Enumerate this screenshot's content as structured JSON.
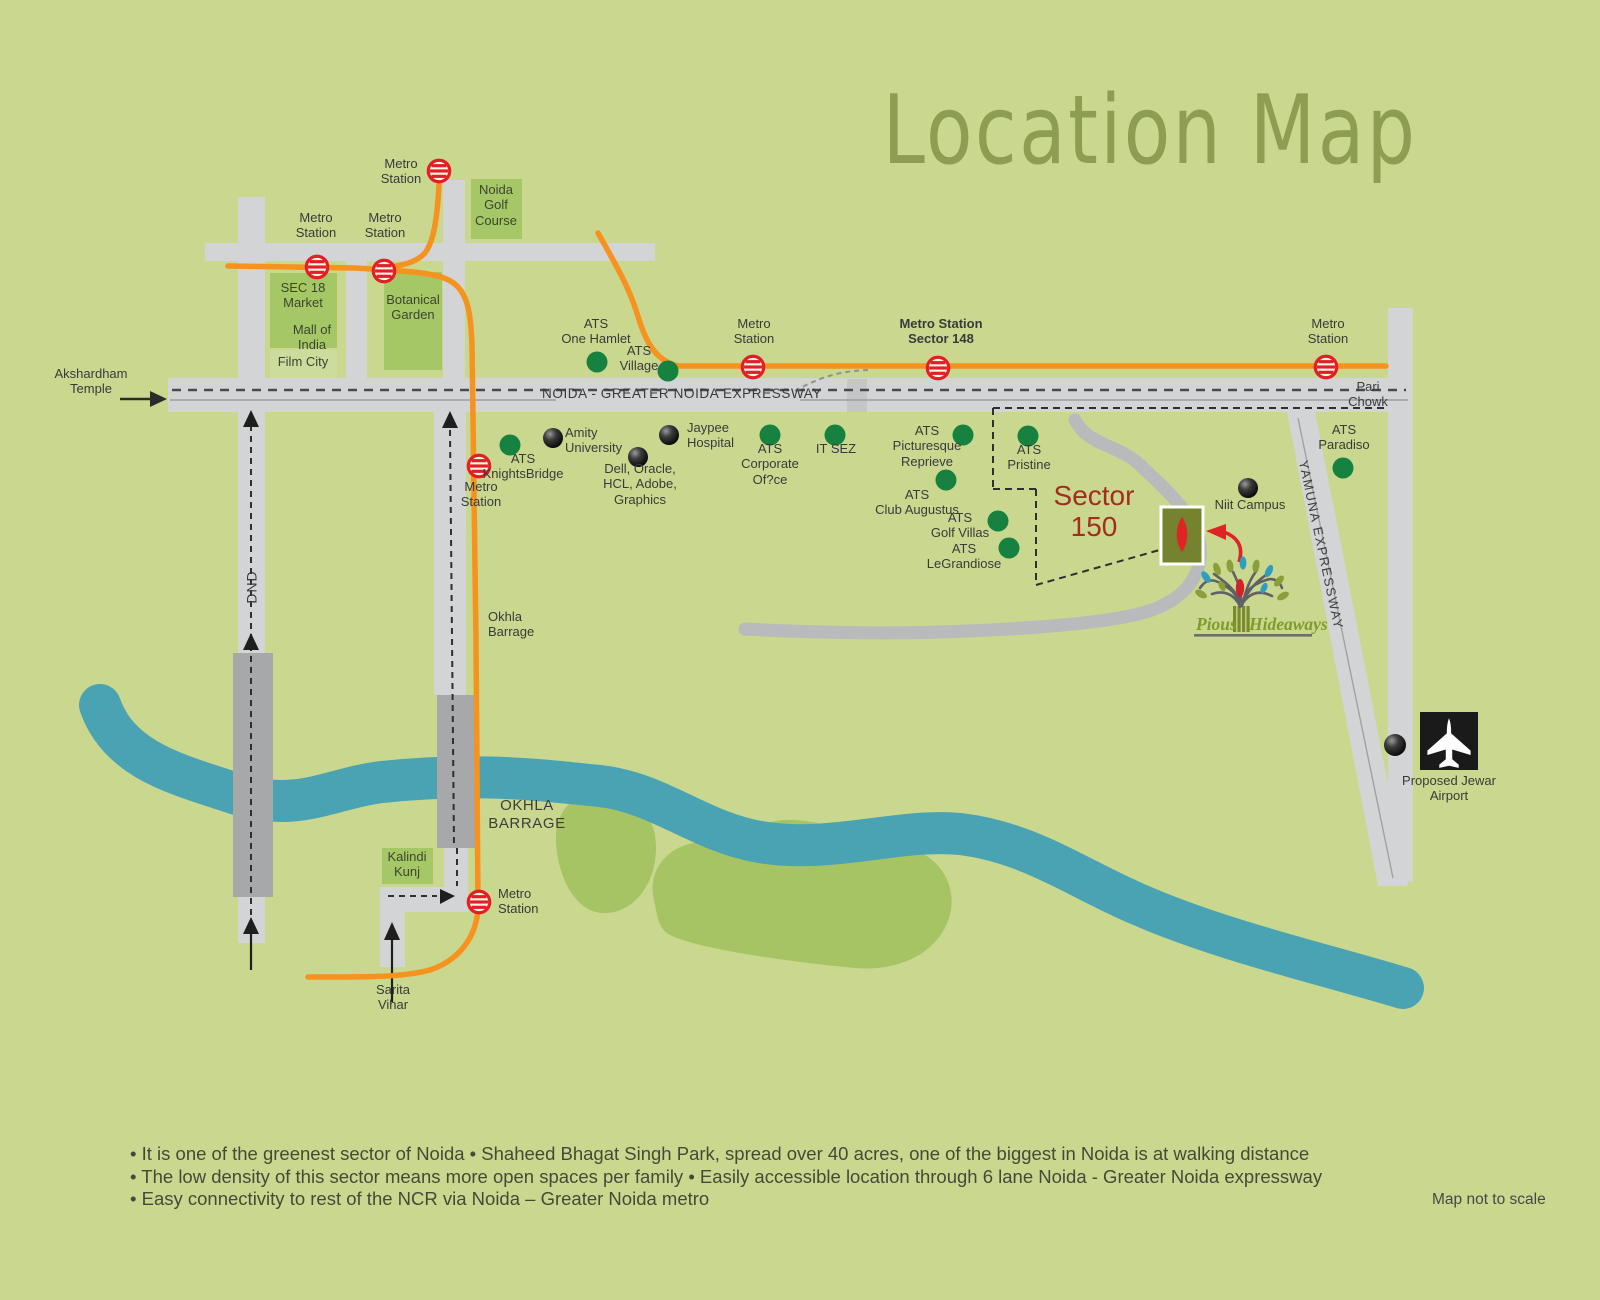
{
  "title": "Location Map",
  "colors": {
    "background": "#c9d78f",
    "road": "#d3d4d6",
    "road_dark": "#a6a8aa",
    "river": "#4aa3b2",
    "metro_line_orange": "#f6921e",
    "green_block": "#a5c765",
    "park_blob": "#a7c464",
    "ats_dot_green": "#17823f",
    "metro_icon_red": "#e21f26",
    "sector_label_red": "#a52d20",
    "title_olive": "#8d9d51",
    "site_box_olive": "#75832f",
    "logo_text_green": "#7f9c2a"
  },
  "texts": {
    "akshardham": "Akshardham\nTemple",
    "metro_station": "Metro\nStation",
    "metro_station_148": "Metro Station\nSector 148",
    "noida_golf": "Noida\nGolf\nCourse",
    "sec18": "SEC 18\nMarket",
    "mall_india": "Mall of\nIndia",
    "film_city": "Film City",
    "botanical": "Botanical\nGarden",
    "ats_one_hamlet": "ATS\nOne Hamlet",
    "ats_village": "ATS\nVillage",
    "ats_knightsbridge": "ATS\nKnightsBridge",
    "amity": "Amity\nUniversity",
    "jaypee": "Jaypee\nHospital",
    "dell": "Dell, Oracle,\nHCL, Adobe,\nGraphics",
    "ats_corporate": "ATS\nCorporate\nOf?ce",
    "it_sez": "IT SEZ",
    "ats_picturesque": "ATS\nPicturesque\nReprieve",
    "ats_pristine": "ATS\nPristine",
    "ats_club": "ATS\nClub Augustus",
    "ats_golf_villas": "ATS\nGolf Villas",
    "ats_legrandiose": "ATS\nLeGrandiose",
    "ats_paradiso": "ATS\nParadiso",
    "sector150": "Sector\n150",
    "niit": "Niit Campus",
    "pari_chowk": "Pari\nChowk",
    "expressway": "NOIDA - GREATER NOIDA EXPRESSWAY",
    "yamuna": "YAMUNA EXPRESSWAY",
    "dnd": "DND",
    "okhla_small": "Okhla\nBarrage",
    "okhla_big": "OKHLA\nBARRAGE",
    "kalindi": "Kalindi\nKunj",
    "sarita": "Sarita\nVihar",
    "jewar": "Proposed Jewar\nAirport",
    "logo_pious": "Pious",
    "logo_hideaways": "Hideaways",
    "map_not_to_scale": "Map not to scale"
  },
  "notes": [
    "It is one of the greenest sector of Noida  •  Shaheed Bhagat Singh Park, spread over 40 acres, one of the biggest in Noida is at walking distance",
    "The low density of this sector means more open spaces per family  •  Easily accessible location through 6 lane Noida - Greater Noida expressway",
    "Easy connectivity to rest of the NCR via Noida – Greater Noida metro"
  ]
}
